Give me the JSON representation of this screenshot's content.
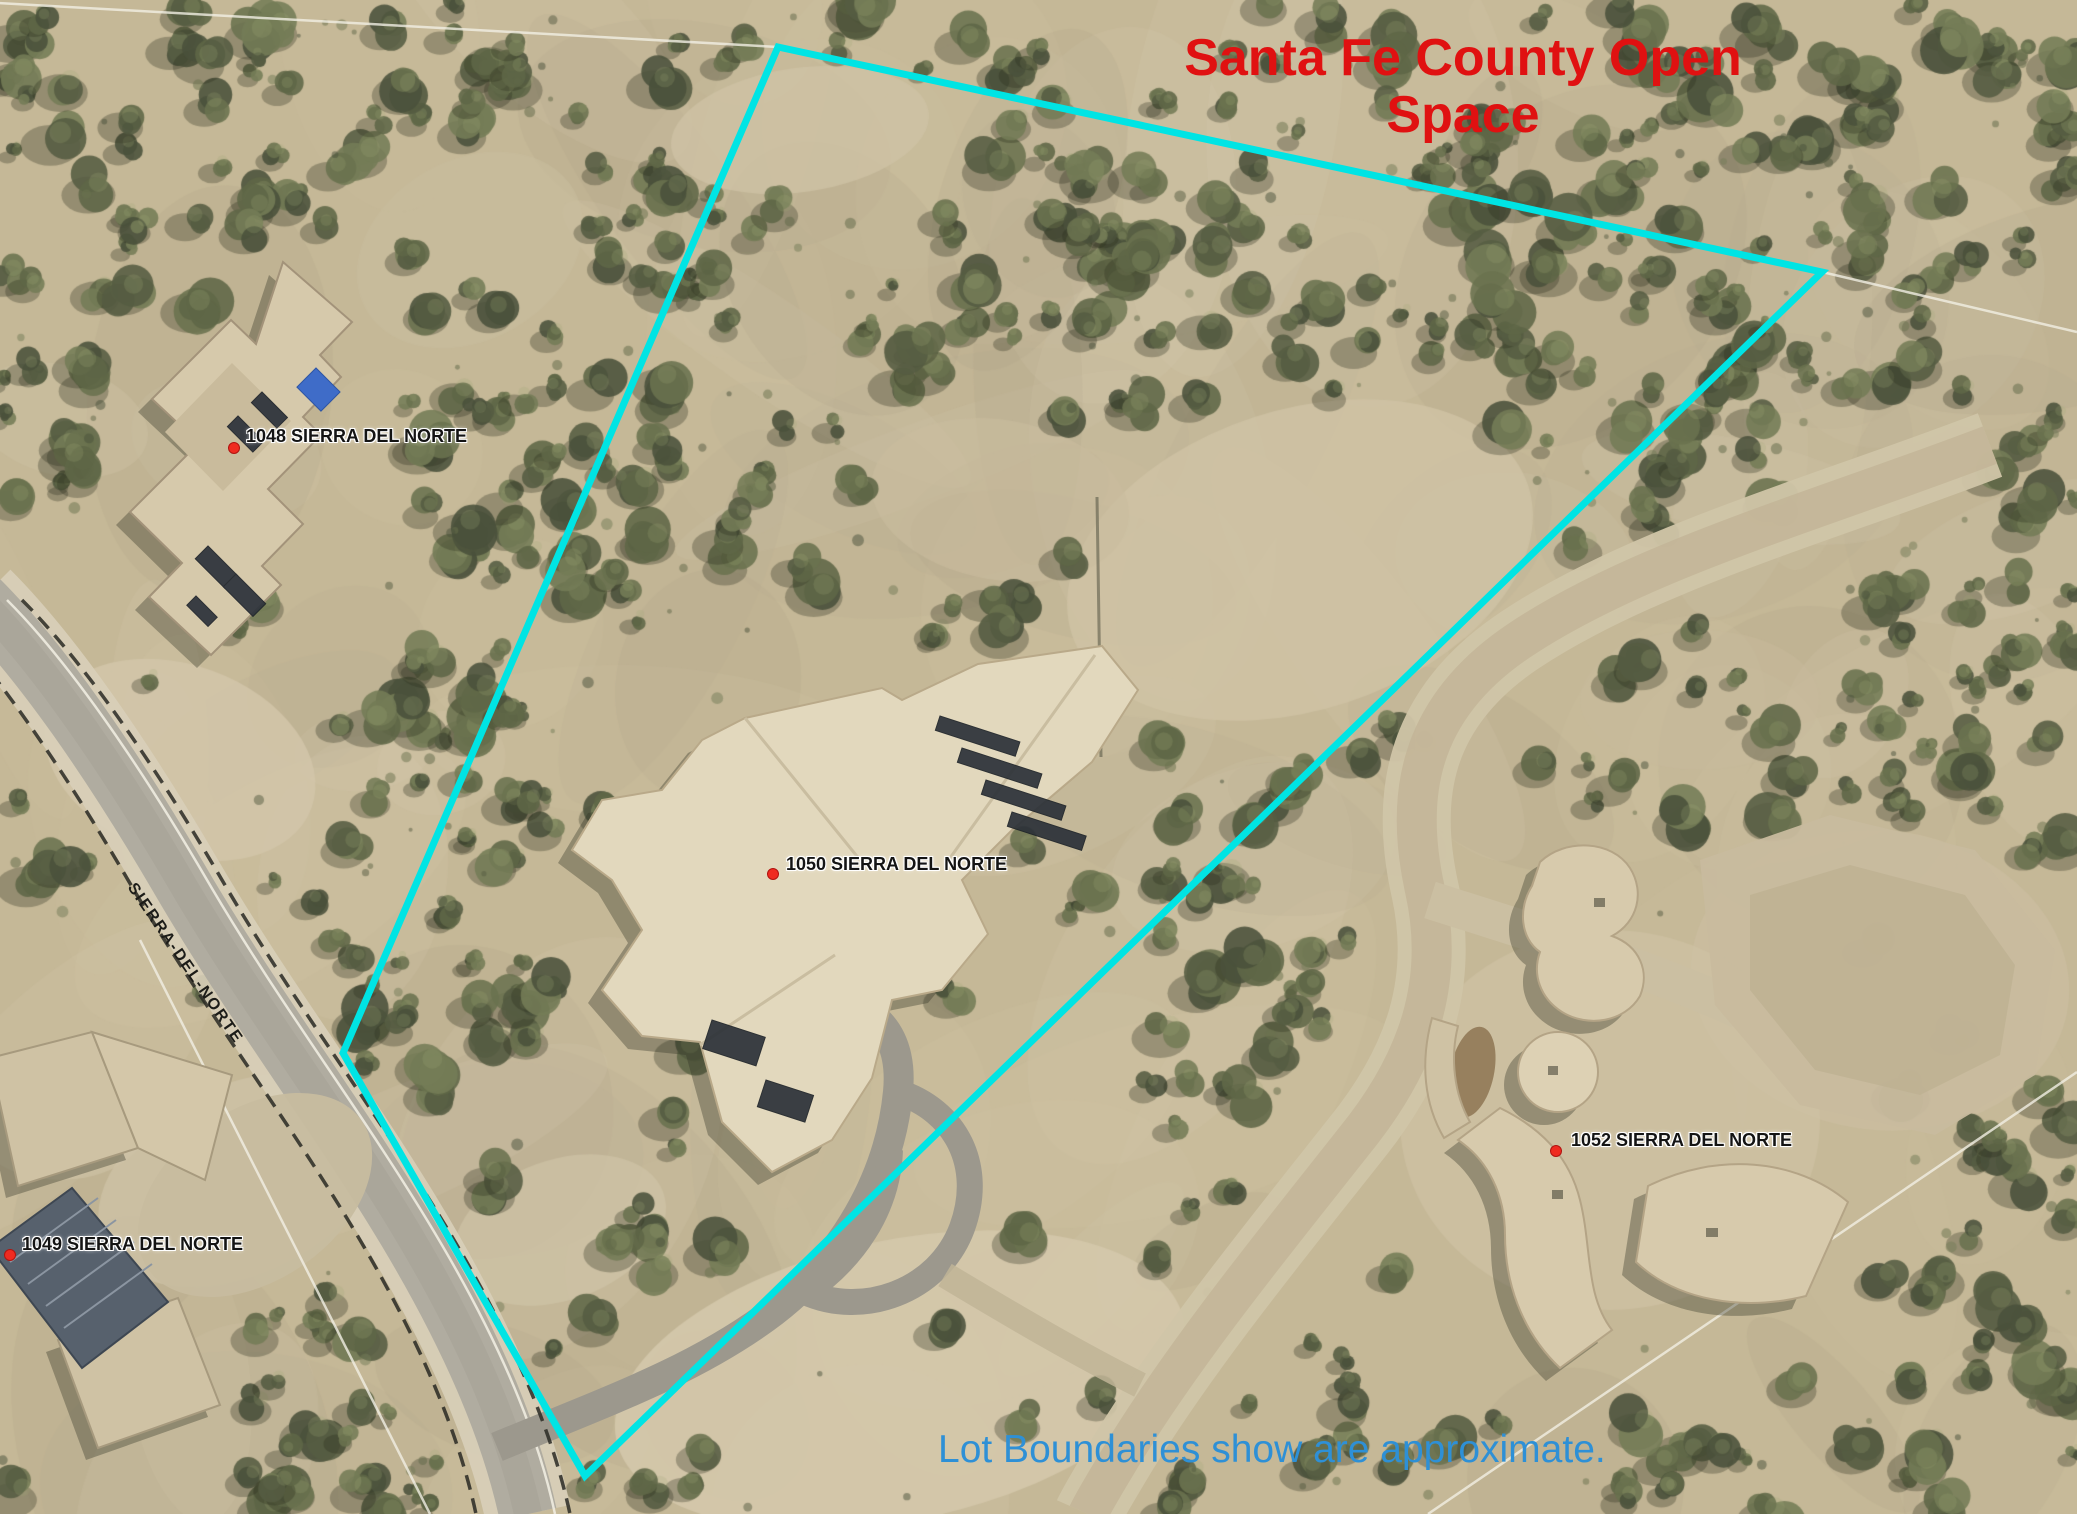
{
  "map": {
    "open_space_title": "Santa Fe County Open Space",
    "disclaimer": "Lot Boundaries show are approximate.",
    "road_label": "SIERRA-DEL-NORTE",
    "parcel_labels": {
      "p1048": "1048 SIERRA DEL NORTE",
      "p1049": "1049 SIERRA DEL NORTE",
      "p1050": "1050 SIERRA DEL NORTE",
      "p1052": "1052 SIERRA DEL NORTE"
    },
    "colors": {
      "boundary_cyan": "#00e4e4",
      "title_red": "#e01111",
      "disclaimer_blue": "#2e90d6",
      "marker_red": "#ef2b20"
    }
  }
}
